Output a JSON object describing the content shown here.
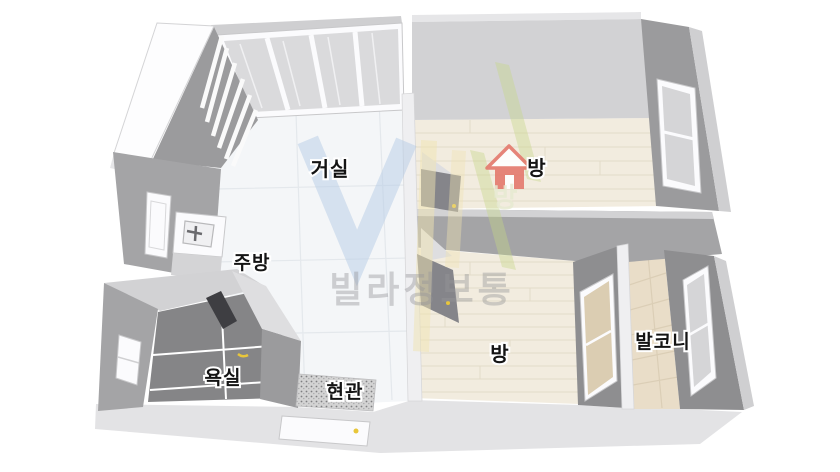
{
  "image": {
    "kind": "3d-floorplan-rendering",
    "background": "#ffffff"
  },
  "rooms": {
    "living": {
      "label": "거실"
    },
    "room_top": {
      "label": "방"
    },
    "kitchen": {
      "label": "주방"
    },
    "bathroom": {
      "label": "욕실"
    },
    "entrance": {
      "label": "현관"
    },
    "room_bottom": {
      "label": "방"
    },
    "balcony": {
      "label": "발코니"
    }
  },
  "watermark": {
    "brand": "빌라정보통",
    "logo_letter_v": "V",
    "faint_room_glyph": "방"
  },
  "palette": {
    "wall_dark": "#8e8e90",
    "wall_mid": "#a4a4a6",
    "wall_light": "#d2d2d4",
    "floor_wood": "#f2ecdf",
    "floor_tile_white": "#f4f6f8",
    "floor_balcony": "#e9ddc8",
    "floor_bathroom": "#858587",
    "floor_entrance_speckle": "#d3d3d3",
    "south_wall_band": "#e3e3e5",
    "house_icon_red": "#e4796d",
    "door_handle_yellow": "#e8c63a",
    "watermark_blue": "#b5cbe5",
    "watermark_green": "#c5d788",
    "watermark_yellow": "#efe3b2",
    "watermark_gray": "#97979a"
  }
}
